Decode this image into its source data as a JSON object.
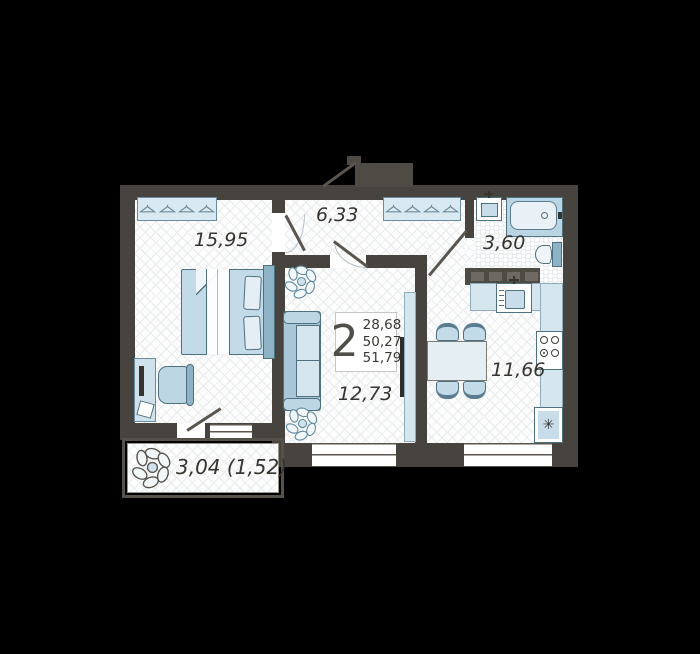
{
  "floorplan": {
    "summary": {
      "rooms_count": "2",
      "areas": [
        "28,68",
        "50,27",
        "51,79"
      ]
    },
    "rooms": {
      "bedroom": {
        "area": "15,95"
      },
      "hallway": {
        "area": "6,33"
      },
      "bathroom": {
        "area": "3,60"
      },
      "kitchen": {
        "area": "11,66"
      },
      "living": {
        "area": "12,73"
      },
      "balcony": {
        "area": "3,04 (1,52)"
      }
    },
    "symbols": {
      "fridge": "✳"
    },
    "colors": {
      "background": "#000000",
      "wall": "#47443f",
      "floor": "#ffffff",
      "furniture_fill": "#c8dde9",
      "furniture_stroke": "#4f707f",
      "text": "#35342f"
    }
  }
}
